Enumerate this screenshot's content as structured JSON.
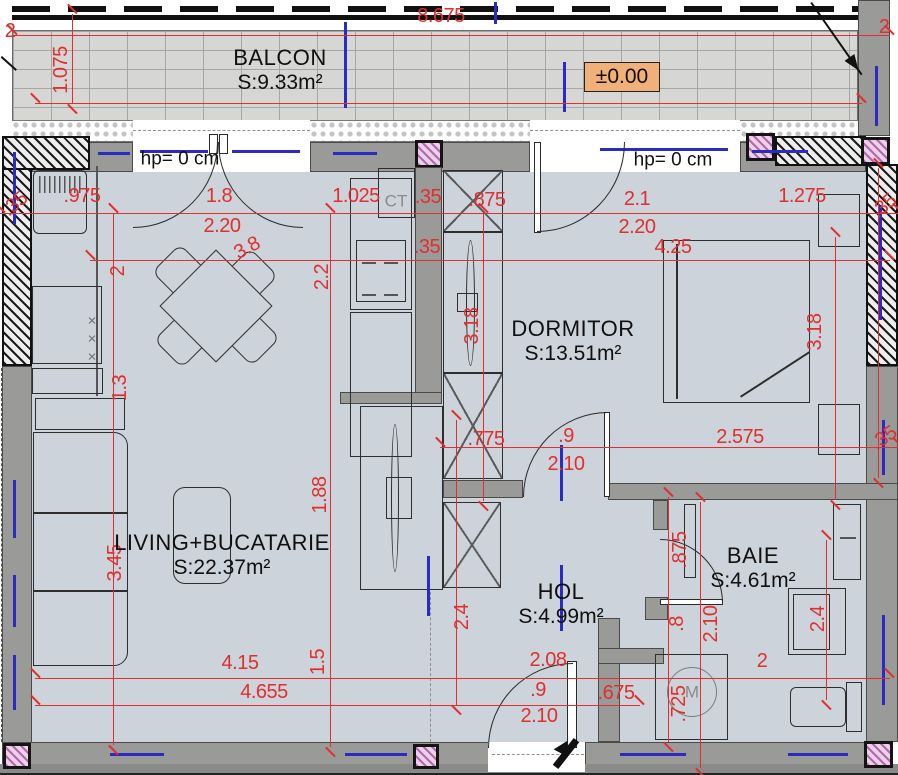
{
  "plan": {
    "level_marker": "±0.00",
    "type_label": "apartment floor plan"
  },
  "rooms": [
    {
      "name": "BALCON",
      "area": "S:9.33m²",
      "x": 280,
      "y": 70
    },
    {
      "name": "DORMITOR",
      "area": "S:13.51m²",
      "x": 573,
      "y": 341
    },
    {
      "name": "LIVING+BUCATARIE",
      "area": "S:22.37m²",
      "x": 222,
      "y": 555
    },
    {
      "name": "HOL",
      "area": "S:4.99m²",
      "x": 561,
      "y": 604
    },
    {
      "name": "BAIE",
      "area": "S:4.61m²",
      "x": 753,
      "y": 568
    }
  ],
  "window_labels": [
    {
      "t": "hp= 0 cm",
      "x": 180,
      "y": 159
    },
    {
      "t": "hp= 0 cm",
      "x": 673,
      "y": 160
    }
  ],
  "equipment_labels": [
    {
      "t": "CT",
      "x": 396,
      "y": 201
    },
    {
      "t": "M",
      "x": 692,
      "y": 692
    },
    {
      "t": "×",
      "x": 92,
      "y": 321,
      "c": "sm"
    },
    {
      "t": "×",
      "x": 92,
      "y": 339,
      "c": "sm"
    },
    {
      "t": "×",
      "x": 92,
      "y": 357,
      "c": "sm"
    }
  ],
  "dimensions": [
    {
      "t": "2",
      "x": 10,
      "y": 31
    },
    {
      "t": "8.675",
      "x": 441,
      "y": 16
    },
    {
      "t": "2",
      "x": 884,
      "y": 27
    },
    {
      "t": "1.075",
      "x": 61,
      "y": 70,
      "r": -90
    },
    {
      "t": ".35",
      "x": 15,
      "y": 204,
      "r": -40
    },
    {
      "t": ".975",
      "x": 82,
      "y": 196
    },
    {
      "t": "1.8",
      "x": 219,
      "y": 196
    },
    {
      "t": "2.20",
      "x": 222,
      "y": 226
    },
    {
      "t": "3.8",
      "x": 247,
      "y": 248,
      "r": -28
    },
    {
      "t": "1.025",
      "x": 356,
      "y": 196
    },
    {
      "t": ".35",
      "x": 428,
      "y": 197
    },
    {
      "t": ".875",
      "x": 487,
      "y": 200
    },
    {
      "t": "2.1",
      "x": 637,
      "y": 199
    },
    {
      "t": "2.20",
      "x": 637,
      "y": 227
    },
    {
      "t": "4.25",
      "x": 673,
      "y": 247
    },
    {
      "t": "1.275",
      "x": 802,
      "y": 196
    },
    {
      "t": ".35",
      "x": 884,
      "y": 206,
      "r": -40
    },
    {
      "t": ".35",
      "x": 427,
      "y": 247
    },
    {
      "t": "2",
      "x": 118,
      "y": 271,
      "r": -90
    },
    {
      "t": "2.2",
      "x": 322,
      "y": 277,
      "r": -90
    },
    {
      "t": "3.18",
      "x": 472,
      "y": 326,
      "r": -90
    },
    {
      "t": "3.18",
      "x": 815,
      "y": 332,
      "r": -90
    },
    {
      "t": "1.3",
      "x": 120,
      "y": 388,
      "r": -90
    },
    {
      "t": "3.45",
      "x": 115,
      "y": 563,
      "r": -90
    },
    {
      "t": "1.88",
      "x": 320,
      "y": 495,
      "r": -90
    },
    {
      "t": ".775",
      "x": 486,
      "y": 439
    },
    {
      "t": ".9",
      "x": 566,
      "y": 436
    },
    {
      "t": "2.10",
      "x": 566,
      "y": 464
    },
    {
      "t": "2.575",
      "x": 740,
      "y": 437
    },
    {
      "t": ".35",
      "x": 884,
      "y": 438,
      "r": -35
    },
    {
      "t": ".875",
      "x": 680,
      "y": 550,
      "r": -90
    },
    {
      "t": "2.4",
      "x": 462,
      "y": 617,
      "r": -90
    },
    {
      "t": ".8",
      "x": 677,
      "y": 624,
      "r": -90
    },
    {
      "t": "2.10",
      "x": 711,
      "y": 624,
      "r": -90
    },
    {
      "t": "2.4",
      "x": 818,
      "y": 619,
      "r": -90
    },
    {
      "t": "2",
      "x": 762,
      "y": 661
    },
    {
      "t": "4.15",
      "x": 240,
      "y": 663
    },
    {
      "t": "1.5",
      "x": 318,
      "y": 662,
      "r": -90
    },
    {
      "t": "4.655",
      "x": 264,
      "y": 692
    },
    {
      "t": "2.08",
      "x": 548,
      "y": 660
    },
    {
      "t": ".9",
      "x": 538,
      "y": 690
    },
    {
      "t": "2.10",
      "x": 539,
      "y": 716
    },
    {
      "t": ".675",
      "x": 616,
      "y": 693
    },
    {
      "t": ".725",
      "x": 679,
      "y": 704,
      "r": -90
    }
  ],
  "colors": {
    "dimension_red": "#e02f2f",
    "axis_blue": "#2b2bc4",
    "wall_gray": "#9a9a98",
    "floor_blue_gray": "#ccd3da",
    "level_marker_bg": "#f2b079",
    "column_pink_hatch": "#ecd2e8"
  }
}
